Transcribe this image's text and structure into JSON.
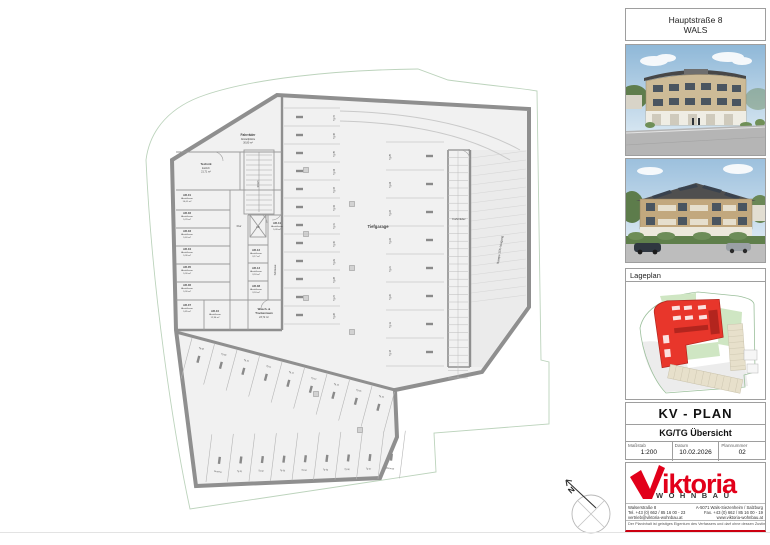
{
  "header": {
    "line1": "Hauptstraße 8",
    "line2": "WALS"
  },
  "lageplan": {
    "title": "Lageplan"
  },
  "titleblock": {
    "plan_type": "KV - PLAN",
    "plan_name": "KG/TG Übersicht",
    "fields": [
      {
        "label": "Maßstab",
        "value": "1:200"
      },
      {
        "label": "Datum",
        "value": "10.02.2026"
      },
      {
        "label": "Plannummer",
        "value": "02"
      }
    ]
  },
  "logo": {
    "brand": "iktoria",
    "sub": "WOHNBAU",
    "color": "#e2001a"
  },
  "contact": {
    "left": [
      "Walserstraße 8",
      "Tel. +43 (0) 662 / 85 16 00 - 23",
      "vertrieb@viktoria-wohnbau.at"
    ],
    "right": [
      "A-5071 Wals-Siezenheim / Salzburg",
      "Fax. +43 (0) 662 / 85 16 00 - 19",
      "www.viktoria-wohnbau.at"
    ],
    "disclaimer": "Der Planinhalt ist geistiges Eigentum des Verfassers und darf ohne dessen Zustimmung weder vervielfältigt noch Dritten zugänglich gemacht werden."
  },
  "plan": {
    "north_label": "N",
    "garage_label": "Tiefgarage",
    "rooms": [
      {
        "code": "AR-01",
        "name": "Abstellraum",
        "area": "10,01 m²",
        "x": 181,
        "y": 196
      },
      {
        "code": "AR-02",
        "name": "Abstellraum",
        "area": "5,29 m²",
        "x": 181,
        "y": 214
      },
      {
        "code": "AR-03",
        "name": "Abstellraum",
        "area": "5,40 m²",
        "x": 181,
        "y": 232
      },
      {
        "code": "AR-04",
        "name": "Abstellraum",
        "area": "5,36 m²",
        "x": 181,
        "y": 250
      },
      {
        "code": "AR-05",
        "name": "Abstellraum",
        "area": "5,30 m²",
        "x": 181,
        "y": 268
      },
      {
        "code": "AR-06",
        "name": "Abstellraum",
        "area": "5,30 m²",
        "x": 181,
        "y": 286
      },
      {
        "code": "AR-07",
        "name": "Abstellraum",
        "area": "5,85 m²",
        "x": 181,
        "y": 306
      },
      {
        "code": "AR-10",
        "name": "Abstellraum",
        "area": "12,96 m²",
        "x": 209,
        "y": 312
      },
      {
        "code": "AR-12",
        "name": "Abstellraum",
        "area": "3,17 m²",
        "x": 250,
        "y": 251
      },
      {
        "code": "AR-13",
        "name": "Abstellraum",
        "area": "3,18 m²",
        "x": 250,
        "y": 269
      },
      {
        "code": "AR-08",
        "name": "Abstellraum",
        "area": "3,18 m²",
        "x": 250,
        "y": 287
      },
      {
        "code": "AR-11",
        "name": "Abstellraum",
        "area": "5,09 m²",
        "x": 271,
        "y": 224
      }
    ],
    "labels": [
      {
        "t": "Fahrräder",
        "x": 248,
        "y": 136,
        "fs": 3.2,
        "b": true
      },
      {
        "t": "Abstellplätze",
        "x": 248,
        "y": 140,
        "fs": 2.5
      },
      {
        "t": "30,80 m²",
        "x": 248,
        "y": 143.5,
        "fs": 2.5
      },
      {
        "t": "Technik",
        "x": 206,
        "y": 165,
        "fs": 3,
        "b": true
      },
      {
        "t": "Estrich",
        "x": 206,
        "y": 169,
        "fs": 2.5
      },
      {
        "t": "21,71 m²",
        "x": 206,
        "y": 172.5,
        "fs": 2.5
      },
      {
        "t": "STGH",
        "x": 259,
        "y": 184,
        "fs": 2.4,
        "rot": -90
      },
      {
        "t": "Flur",
        "x": 239,
        "y": 227,
        "fs": 2.8
      },
      {
        "t": "Lift",
        "x": 258,
        "y": 228,
        "fs": 2.6
      },
      {
        "t": "Schleuse",
        "x": 276,
        "y": 270,
        "fs": 2.6,
        "rot": -90
      },
      {
        "t": "Wasch- &",
        "x": 264,
        "y": 310,
        "fs": 2.8,
        "b": true
      },
      {
        "t": "Trockenraum",
        "x": 264,
        "y": 314,
        "fs": 2.8,
        "b": true
      },
      {
        "t": "23,72 m²",
        "x": 264,
        "y": 318,
        "fs": 2.5
      },
      {
        "t": "Tiefgarage",
        "x": 378,
        "y": 228,
        "fs": 4.2,
        "b": true
      },
      {
        "t": "Fahrräder",
        "x": 459,
        "y": 220,
        "fs": 3
      },
      {
        "t": "Rampe 15% Neigung",
        "x": 501,
        "y": 250,
        "fs": 3,
        "rot": -81
      }
    ],
    "stall_columns": [
      {
        "x1": 284,
        "x2": 340,
        "y0": 108,
        "step": 18,
        "lines": 13,
        "labelX": 335,
        "stopX": 296,
        "labels": [
          "Tg 37",
          "Tg 36",
          "Tg 35",
          "Tg 34",
          "Tg 33",
          "Tg 32",
          "Tg 31",
          "Tg 30",
          "Tg 29",
          "Tg 28",
          "Tg 27",
          "Tg 26"
        ]
      },
      {
        "x1": 386,
        "x2": 444,
        "y0": 142,
        "step": 28,
        "lines": 9,
        "labelX": 391,
        "stopX": 426,
        "labels": [
          "Tg 25",
          "Tg 24",
          "Tg 23",
          "Tg 22",
          "Tg 21",
          "Tg 20",
          "Tg 19",
          "Tg 18"
        ]
      }
    ],
    "bottom_rows": [
      {
        "x0": 192,
        "y0": 338,
        "dx": 22.5,
        "dy": 6.0,
        "len": 42,
        "ang": 105,
        "n": 10,
        "lrot": 15,
        "labels": [
          "Tg 08",
          "Tg 09",
          "Tg 10",
          "Tg 11",
          "Tg 12",
          "Tg 13",
          "Tg 14",
          "Tg 15",
          "Tg 16"
        ]
      },
      {
        "x0": 206,
        "y0": 482,
        "dx": 21.5,
        "dy": -0.4,
        "len": 48,
        "ang": -83,
        "n": 10,
        "lrot": 7,
        "labels": [
          "Reserve",
          "Tg 01",
          "Tg 02",
          "Tg 03",
          "Tg 04",
          "Tg 05",
          "Tg 06",
          "Tg 07",
          "Motorrad"
        ]
      }
    ],
    "bike_cells": {
      "x1": 448,
      "x2": 468,
      "y0": 150,
      "step": 7.6,
      "n": 30
    }
  }
}
